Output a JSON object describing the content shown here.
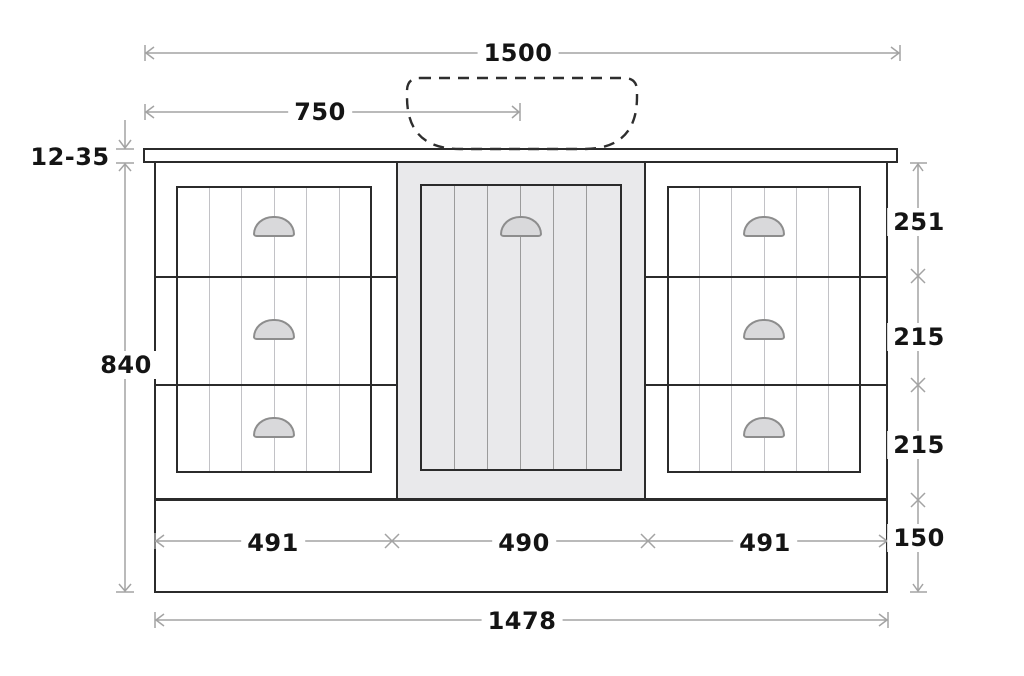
{
  "diagram": {
    "title": "vanity cabinet front elevation with dimensions",
    "dimensions": {
      "total_width": "1500",
      "sink_center_offset": "750",
      "top_thickness": "12-35",
      "cabinet_height": "840",
      "drawer_top_height": "251",
      "drawer_middle_height": "215",
      "drawer_bottom_height": "215",
      "plinth_height": "150",
      "left_section_width": "491",
      "center_section_width": "490",
      "right_section_width": "491",
      "carcass_width": "1478"
    },
    "icons": {
      "drawer_handle": "cup-pull-handle",
      "sink_outline": "dashed-basin-outline",
      "dimension_marker": "arrow-and-cross-tick"
    },
    "colors": {
      "outline": "#2b2b2b",
      "dimension_line": "#a3a3a3",
      "door_panel_fill": "#e9e9eb",
      "handle_fill": "#d9d9db",
      "handle_stroke": "#8d8d8d",
      "bead_line_on_white": "#c2c2c6",
      "bead_line_on_gray": "#9b9b9b",
      "label_text": "#141414",
      "background": "#ffffff"
    }
  }
}
